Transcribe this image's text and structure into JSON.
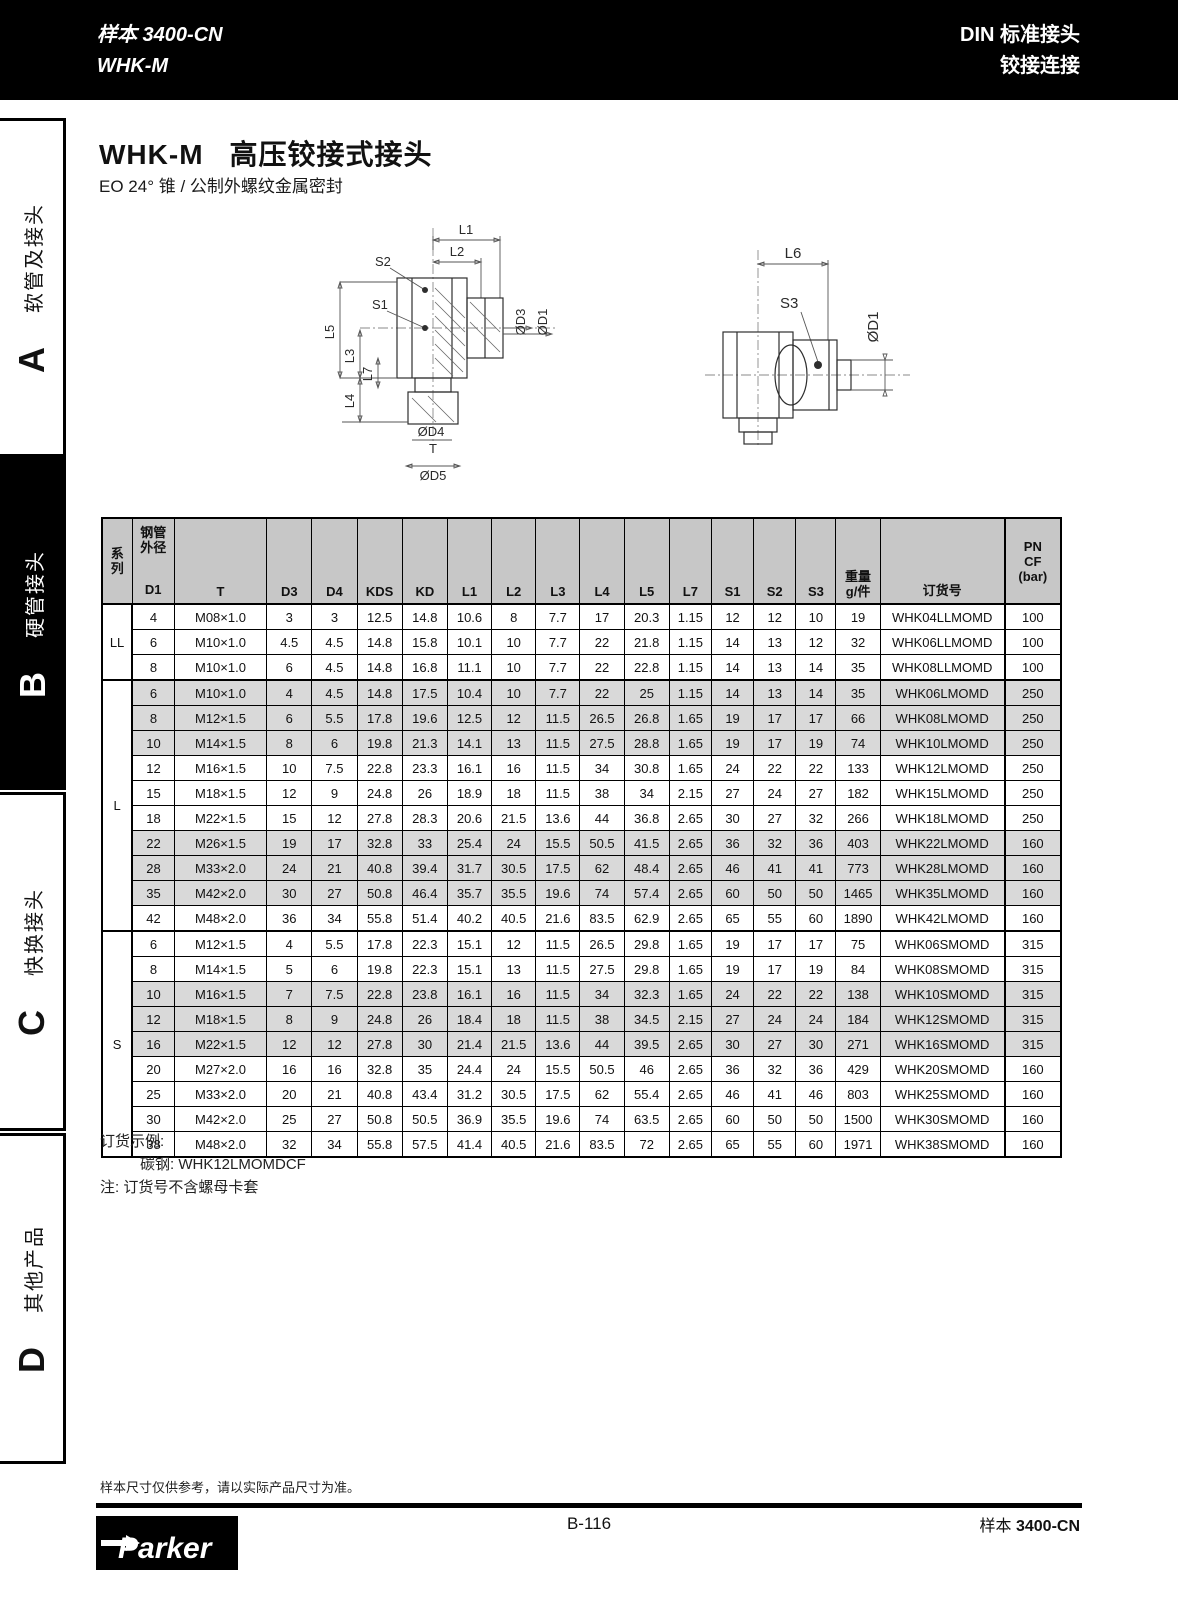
{
  "page_header": {
    "catalog": "样本 3400-CN",
    "model": "WHK-M",
    "right_line1": "DIN 标准接头",
    "right_line2": "铰接连接"
  },
  "sidebar": {
    "sections": [
      {
        "letter": "A",
        "label": "软管及接头"
      },
      {
        "letter": "B",
        "label": "硬管接头"
      },
      {
        "letter": "C",
        "label": "快换接头"
      },
      {
        "letter": "D",
        "label": "其他产品"
      }
    ]
  },
  "title": {
    "code": "WHK-M",
    "name": "高压铰接式接头",
    "description": "EO 24° 锥 / 公制外螺纹金属密封"
  },
  "diagrams": {
    "left": {
      "labels": {
        "l1": "L1",
        "l2": "L2",
        "s2": "S2",
        "s1": "S1",
        "l5": "L5",
        "l3": "L3",
        "l7": "L7",
        "l4": "L4",
        "d3": "ØD3",
        "d1": "ØD1",
        "d4": "ØD4",
        "t": "T",
        "d5": "ØD5"
      }
    },
    "right": {
      "labels": {
        "l6": "L6",
        "s3": "S3",
        "d1": "ØD1"
      }
    }
  },
  "table": {
    "headers": {
      "series_1": "系",
      "series_2": "列",
      "d1_group_1": "钢管",
      "d1_group_2": "外径",
      "d1": "D1",
      "t": "T",
      "d3": "D3",
      "d4": "D4",
      "kds": "KDS",
      "kd": "KD",
      "l1": "L1",
      "l2": "L2",
      "l3": "L3",
      "l4": "L4",
      "l5": "L5",
      "l7": "L7",
      "s1": "S1",
      "s2": "S2",
      "s3": "S3",
      "weight_1": "重量",
      "weight_2": "g/件",
      "order": "订货号",
      "pn_1": "PN",
      "pn_2": "CF",
      "pn_3": "(bar)"
    },
    "sections": [
      {
        "series": "LL",
        "rows": [
          {
            "shaded": false,
            "cells": [
              "4",
              "M08×1.0",
              "3",
              "3",
              "12.5",
              "14.8",
              "10.6",
              "8",
              "7.7",
              "17",
              "20.3",
              "1.15",
              "12",
              "12",
              "10",
              "19",
              "WHK04LLMOMD",
              "100"
            ]
          },
          {
            "shaded": false,
            "cells": [
              "6",
              "M10×1.0",
              "4.5",
              "4.5",
              "14.8",
              "15.8",
              "10.1",
              "10",
              "7.7",
              "22",
              "21.8",
              "1.15",
              "14",
              "13",
              "12",
              "32",
              "WHK06LLMOMD",
              "100"
            ]
          },
          {
            "shaded": false,
            "cells": [
              "8",
              "M10×1.0",
              "6",
              "4.5",
              "14.8",
              "16.8",
              "11.1",
              "10",
              "7.7",
              "22",
              "22.8",
              "1.15",
              "14",
              "13",
              "14",
              "35",
              "WHK08LLMOMD",
              "100"
            ]
          }
        ]
      },
      {
        "series": "L",
        "rows": [
          {
            "shaded": true,
            "cells": [
              "6",
              "M10×1.0",
              "4",
              "4.5",
              "14.8",
              "17.5",
              "10.4",
              "10",
              "7.7",
              "22",
              "25",
              "1.15",
              "14",
              "13",
              "14",
              "35",
              "WHK06LMOMD",
              "250"
            ]
          },
          {
            "shaded": true,
            "cells": [
              "8",
              "M12×1.5",
              "6",
              "5.5",
              "17.8",
              "19.6",
              "12.5",
              "12",
              "11.5",
              "26.5",
              "26.8",
              "1.65",
              "19",
              "17",
              "17",
              "66",
              "WHK08LMOMD",
              "250"
            ]
          },
          {
            "shaded": true,
            "cells": [
              "10",
              "M14×1.5",
              "8",
              "6",
              "19.8",
              "21.3",
              "14.1",
              "13",
              "11.5",
              "27.5",
              "28.8",
              "1.65",
              "19",
              "17",
              "19",
              "74",
              "WHK10LMOMD",
              "250"
            ]
          },
          {
            "shaded": false,
            "cells": [
              "12",
              "M16×1.5",
              "10",
              "7.5",
              "22.8",
              "23.3",
              "16.1",
              "16",
              "11.5",
              "34",
              "30.8",
              "1.65",
              "24",
              "22",
              "22",
              "133",
              "WHK12LMOMD",
              "250"
            ]
          },
          {
            "shaded": false,
            "cells": [
              "15",
              "M18×1.5",
              "12",
              "9",
              "24.8",
              "26",
              "18.9",
              "18",
              "11.5",
              "38",
              "34",
              "2.15",
              "27",
              "24",
              "27",
              "182",
              "WHK15LMOMD",
              "250"
            ]
          },
          {
            "shaded": false,
            "cells": [
              "18",
              "M22×1.5",
              "15",
              "12",
              "27.8",
              "28.3",
              "20.6",
              "21.5",
              "13.6",
              "44",
              "36.8",
              "2.65",
              "30",
              "27",
              "32",
              "266",
              "WHK18LMOMD",
              "250"
            ]
          },
          {
            "shaded": true,
            "cells": [
              "22",
              "M26×1.5",
              "19",
              "17",
              "32.8",
              "33",
              "25.4",
              "24",
              "15.5",
              "50.5",
              "41.5",
              "2.65",
              "36",
              "32",
              "36",
              "403",
              "WHK22LMOMD",
              "160"
            ]
          },
          {
            "shaded": true,
            "cells": [
              "28",
              "M33×2.0",
              "24",
              "21",
              "40.8",
              "39.4",
              "31.7",
              "30.5",
              "17.5",
              "62",
              "48.4",
              "2.65",
              "46",
              "41",
              "41",
              "773",
              "WHK28LMOMD",
              "160"
            ]
          },
          {
            "shaded": true,
            "cells": [
              "35",
              "M42×2.0",
              "30",
              "27",
              "50.8",
              "46.4",
              "35.7",
              "35.5",
              "19.6",
              "74",
              "57.4",
              "2.65",
              "60",
              "50",
              "50",
              "1465",
              "WHK35LMOMD",
              "160"
            ]
          },
          {
            "shaded": false,
            "cells": [
              "42",
              "M48×2.0",
              "36",
              "34",
              "55.8",
              "51.4",
              "40.2",
              "40.5",
              "21.6",
              "83.5",
              "62.9",
              "2.65",
              "65",
              "55",
              "60",
              "1890",
              "WHK42LMOMD",
              "160"
            ]
          }
        ]
      },
      {
        "series": "S",
        "rows": [
          {
            "shaded": false,
            "cells": [
              "6",
              "M12×1.5",
              "4",
              "5.5",
              "17.8",
              "22.3",
              "15.1",
              "12",
              "11.5",
              "26.5",
              "29.8",
              "1.65",
              "19",
              "17",
              "17",
              "75",
              "WHK06SMOMD",
              "315"
            ]
          },
          {
            "shaded": false,
            "cells": [
              "8",
              "M14×1.5",
              "5",
              "6",
              "19.8",
              "22.3",
              "15.1",
              "13",
              "11.5",
              "27.5",
              "29.8",
              "1.65",
              "19",
              "17",
              "19",
              "84",
              "WHK08SMOMD",
              "315"
            ]
          },
          {
            "shaded": true,
            "cells": [
              "10",
              "M16×1.5",
              "7",
              "7.5",
              "22.8",
              "23.8",
              "16.1",
              "16",
              "11.5",
              "34",
              "32.3",
              "1.65",
              "24",
              "22",
              "22",
              "138",
              "WHK10SMOMD",
              "315"
            ]
          },
          {
            "shaded": true,
            "cells": [
              "12",
              "M18×1.5",
              "8",
              "9",
              "24.8",
              "26",
              "18.4",
              "18",
              "11.5",
              "38",
              "34.5",
              "2.15",
              "27",
              "24",
              "24",
              "184",
              "WHK12SMOMD",
              "315"
            ]
          },
          {
            "shaded": true,
            "cells": [
              "16",
              "M22×1.5",
              "12",
              "12",
              "27.8",
              "30",
              "21.4",
              "21.5",
              "13.6",
              "44",
              "39.5",
              "2.65",
              "30",
              "27",
              "30",
              "271",
              "WHK16SMOMD",
              "315"
            ]
          },
          {
            "shaded": false,
            "cells": [
              "20",
              "M27×2.0",
              "16",
              "16",
              "32.8",
              "35",
              "24.4",
              "24",
              "15.5",
              "50.5",
              "46",
              "2.65",
              "36",
              "32",
              "36",
              "429",
              "WHK20SMOMD",
              "160"
            ]
          },
          {
            "shaded": false,
            "cells": [
              "25",
              "M33×2.0",
              "20",
              "21",
              "40.8",
              "43.4",
              "31.2",
              "30.5",
              "17.5",
              "62",
              "55.4",
              "2.65",
              "46",
              "41",
              "46",
              "803",
              "WHK25SMOMD",
              "160"
            ]
          },
          {
            "shaded": false,
            "cells": [
              "30",
              "M42×2.0",
              "25",
              "27",
              "50.8",
              "50.5",
              "36.9",
              "35.5",
              "19.6",
              "74",
              "63.5",
              "2.65",
              "60",
              "50",
              "50",
              "1500",
              "WHK30SMOMD",
              "160"
            ]
          },
          {
            "shaded": false,
            "cells": [
              "38",
              "M48×2.0",
              "32",
              "34",
              "55.8",
              "57.5",
              "41.4",
              "40.5",
              "21.6",
              "83.5",
              "72",
              "2.65",
              "65",
              "55",
              "60",
              "1971",
              "WHK38SMOMD",
              "160"
            ]
          }
        ]
      }
    ]
  },
  "notes": {
    "example_title": "订货示例:",
    "example_line": "碳钢: WHK12LMOMDCF",
    "note_line": "注: 订货号不含螺母卡套"
  },
  "footer": {
    "disclaimer": "样本尺寸仅供参考，请以实际产品尺寸为准。",
    "page": "B-116",
    "catalog_prefix": "样本 ",
    "catalog_code": "3400-CN",
    "brand": "Parker"
  }
}
